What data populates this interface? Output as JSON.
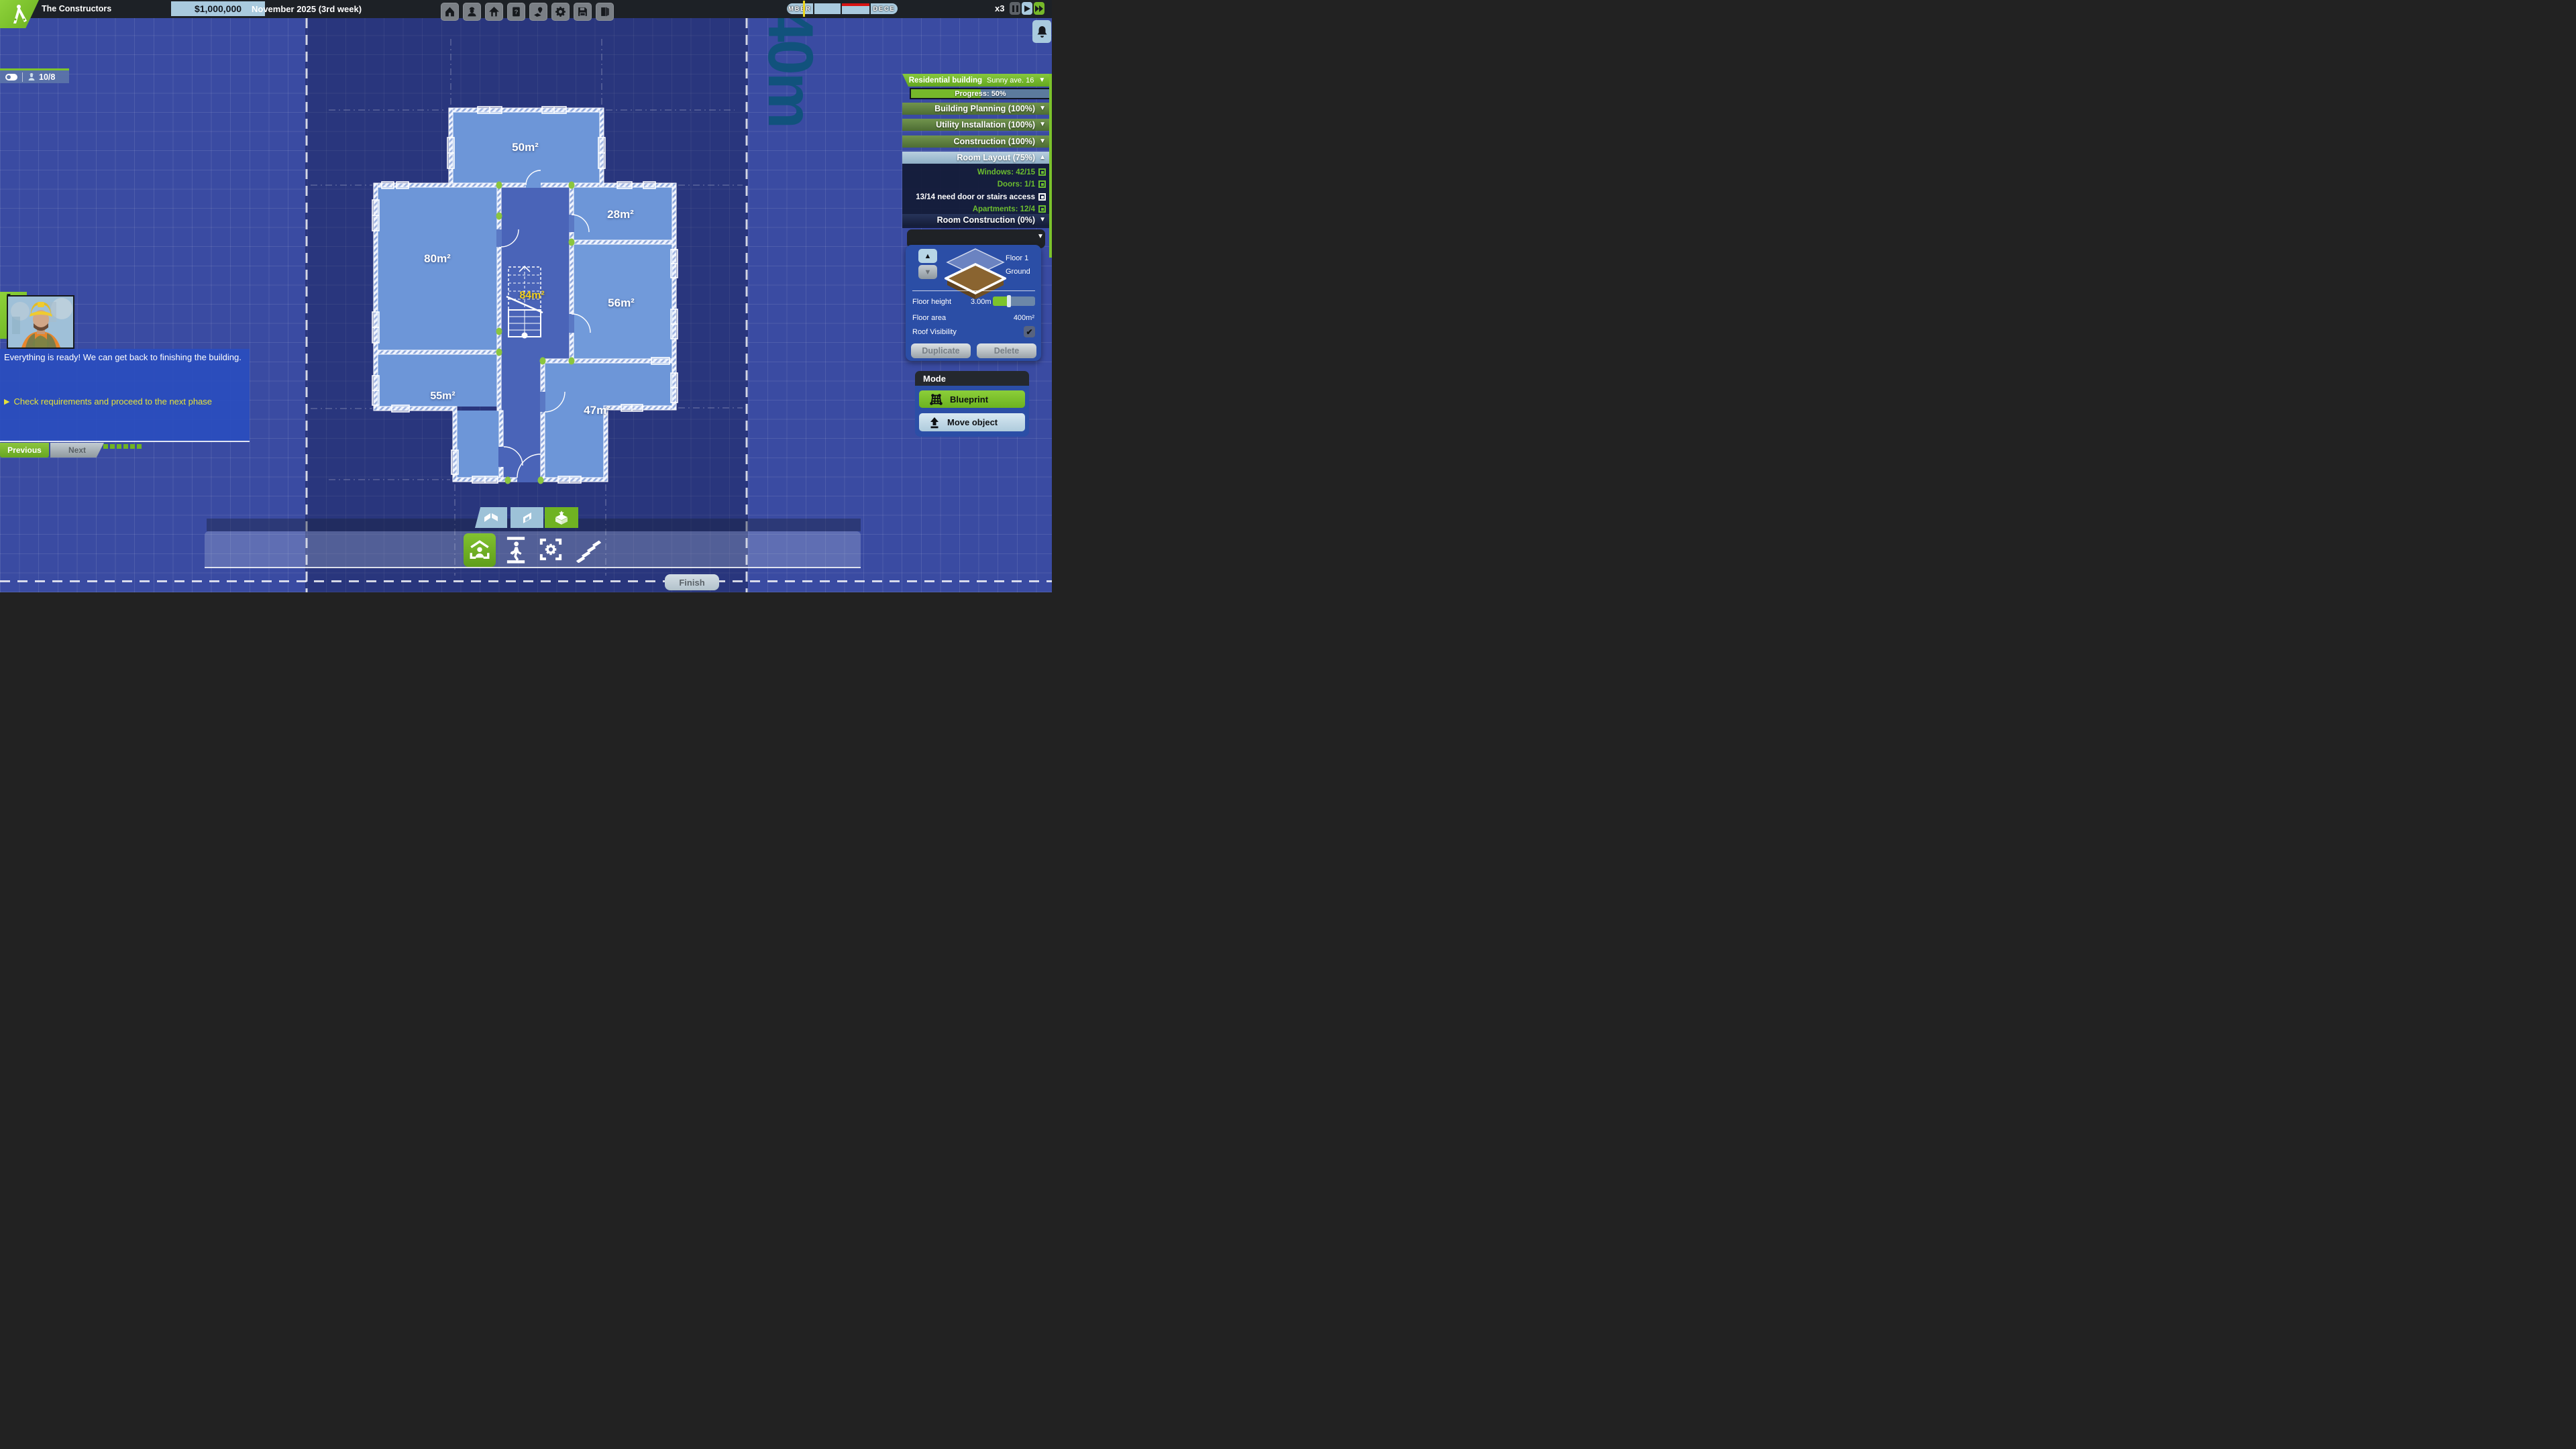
{
  "colors": {
    "accent_green": "#7cc32c",
    "light_blue": "#a9cade",
    "status_green": "#6cbd2f",
    "objective_yellow": "#e5e23a",
    "room_label_yellow": "#f2cf1c",
    "dim_label": "#11527c"
  },
  "topbar": {
    "app_title": "The Constructors",
    "money": "$1,000,000",
    "date": "November 2025 (3rd week)",
    "icons": [
      "home",
      "crew",
      "building",
      "help",
      "map",
      "settings",
      "save",
      "exit"
    ],
    "speed": "x3"
  },
  "timeline": {
    "segments": [
      {
        "label": "MBER"
      },
      {
        "label": ""
      },
      {
        "label": ""
      },
      {
        "label": "DECE"
      }
    ]
  },
  "crew": {
    "count": "10/8"
  },
  "plot": {
    "dimension": "40m"
  },
  "rooms": [
    {
      "label": "50m²"
    },
    {
      "label": "80m²"
    },
    {
      "label": "28m²"
    },
    {
      "label": "84m²"
    },
    {
      "label": "56m²"
    },
    {
      "label": "55m²"
    },
    {
      "label": "47m²"
    }
  ],
  "building_panel": {
    "type": "Residential building",
    "address": "Sunny ave. 16",
    "progress": "Progress: 50%",
    "phases": [
      {
        "label": "Building Planning (100%)"
      },
      {
        "label": "Utility Installation (100%)"
      },
      {
        "label": "Construction (100%)"
      },
      {
        "label": "Room Layout (75%)"
      },
      {
        "label": "Room Construction (0%)"
      }
    ],
    "checks": [
      {
        "label": "Windows: 42/15",
        "status": "ok"
      },
      {
        "label": "Doors: 1/1",
        "status": "ok"
      },
      {
        "label": "13/14 need door or stairs access",
        "status": "warn"
      },
      {
        "label": "Apartments: 12/4",
        "status": "ok"
      }
    ],
    "floor_selector": {
      "floor_up_label": "Floor 1",
      "floor_current_label": "Ground",
      "floor_height_label": "Floor height",
      "floor_height_value": "3.00m",
      "floor_area_label": "Floor area",
      "floor_area_value": "400m²",
      "roof_label": "Roof Visibility",
      "duplicate": "Duplicate",
      "delete": "Delete"
    }
  },
  "mode_panel": {
    "title": "Mode",
    "blueprint": "Blueprint",
    "move_object": "Move object"
  },
  "dialog": {
    "message": "Everything is ready! We can get back to finishing the building.",
    "objective": "Check requirements and proceed to the next phase",
    "previous": "Previous",
    "next": "Next"
  },
  "bottom": {
    "finish": "Finish"
  }
}
